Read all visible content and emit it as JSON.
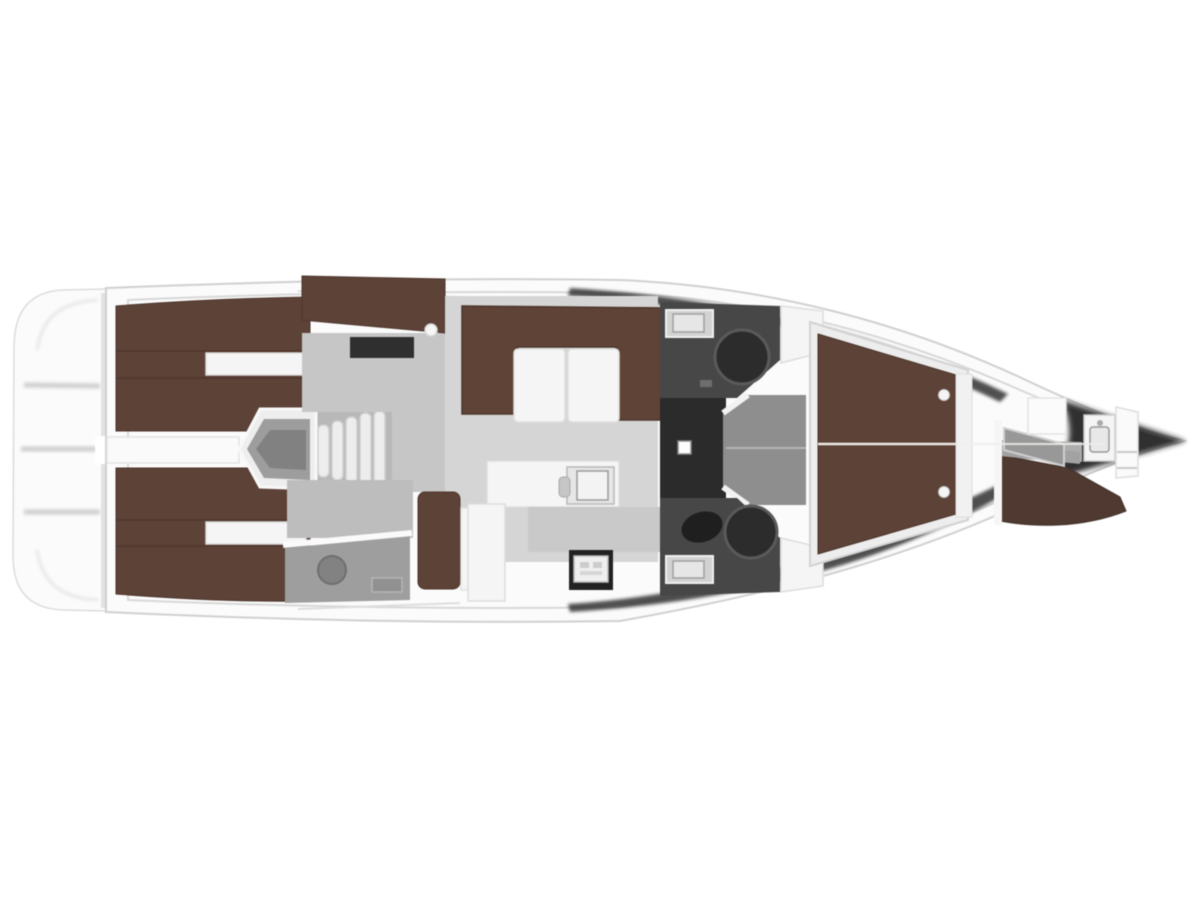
{
  "page": {
    "background": "#ffffff",
    "subject": "sailing-yacht-interior-deck-plan",
    "orientation": "bow-right-stern-left",
    "visible_text": ""
  },
  "colors": {
    "hull_white": "#fbfbfb",
    "hull_stroke": "#d0d0d0",
    "deck_line": "#d8d8d8",
    "floor_light": "#d5d5d5",
    "floor_mid": "#c6c6c6",
    "floor_dim": "#9e9e9e",
    "berth_brown": "#5d4237",
    "sofa_brown": "#5f4336",
    "berth_brown_dark": "#4f3930",
    "head_floor": "#474747",
    "corridor_dark": "#2b2b2b",
    "fixture_dark": "#262626",
    "furniture_white": "#f5f5f5",
    "counter_gray": "#cfcfcf",
    "shadow_dark": "#3e3e3e",
    "stove_dark": "#222222",
    "lobby_gray": "#8e8e8e",
    "step_white": "#ededed"
  },
  "areas": [
    {
      "name": "swim-platform",
      "color_key": "hull_white"
    },
    {
      "name": "aft-cabin-port-berth",
      "color_key": "berth_brown"
    },
    {
      "name": "aft-cabin-starboard-berth",
      "color_key": "berth_brown"
    },
    {
      "name": "companionway-steps",
      "color_key": "step_white"
    },
    {
      "name": "nav-sideboard",
      "color_key": "berth_brown"
    },
    {
      "name": "aft-head",
      "color_key": "floor_dim"
    },
    {
      "name": "salon-u-sofa",
      "color_key": "sofa_brown"
    },
    {
      "name": "salon-folding-table",
      "color_key": "furniture_white"
    },
    {
      "name": "chaise-longue",
      "color_key": "berth_brown"
    },
    {
      "name": "galley-counter",
      "color_key": "furniture_white"
    },
    {
      "name": "galley-stove",
      "color_key": "stove_dark"
    },
    {
      "name": "starboard-head",
      "color_key": "head_floor"
    },
    {
      "name": "port-head",
      "color_key": "head_floor"
    },
    {
      "name": "midship-corridor",
      "color_key": "corridor_dark"
    },
    {
      "name": "owner-cabin-berth",
      "color_key": "berth_brown"
    },
    {
      "name": "bow-crew-berth",
      "color_key": "berth_brown_dark"
    },
    {
      "name": "anchor-locker",
      "color_key": "fixture_dark"
    }
  ]
}
